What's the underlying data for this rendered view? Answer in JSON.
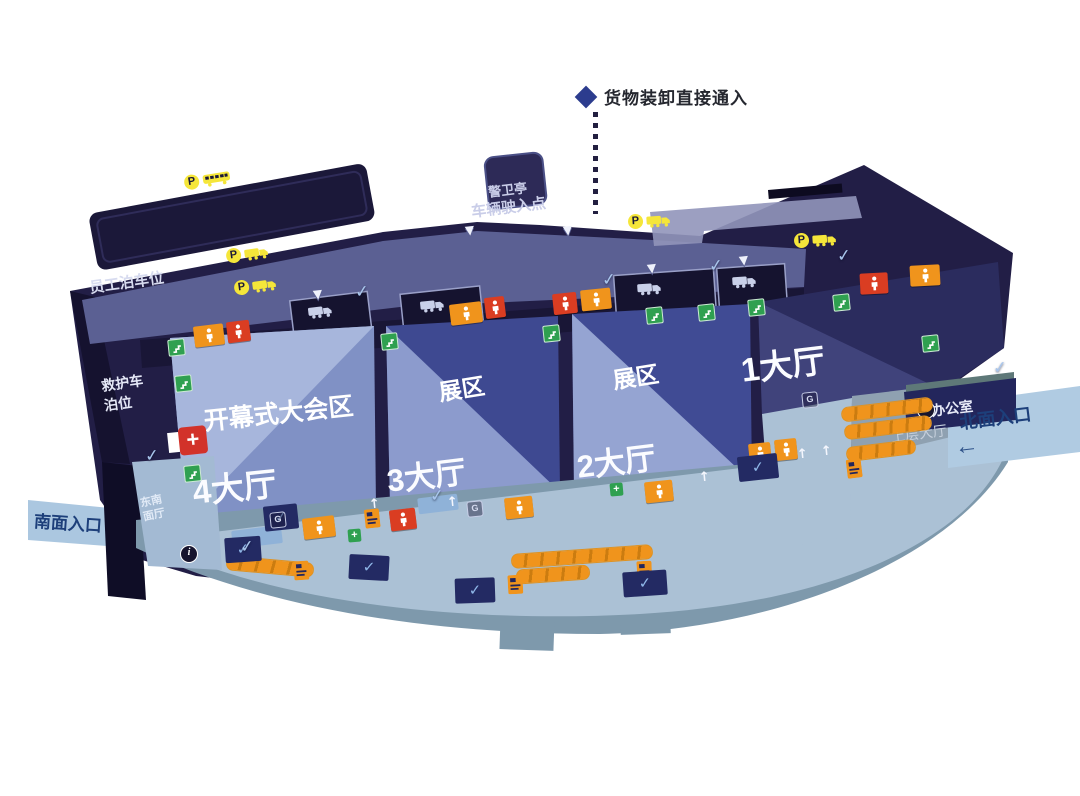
{
  "legend": {
    "label": "货物装卸直接通入"
  },
  "top_area": {
    "guard_booth": "警卫亭",
    "vehicle_entry_point": "车辆驶入点"
  },
  "west_area": {
    "staff_parking": "员工泊车位",
    "ambulance_parking_line1": "救护车",
    "ambulance_parking_line2": "泊位",
    "southeast_hall_line1": "东南",
    "southeast_hall_line2": "面厅"
  },
  "halls": {
    "hall1": {
      "name": "1大厅"
    },
    "hall2": {
      "name": "2大厅",
      "zone": "展区"
    },
    "hall3": {
      "name": "3大厅",
      "zone": "展区"
    },
    "hall4": {
      "name": "4大厅",
      "zone": "开幕式大会区"
    }
  },
  "east_area": {
    "office": "办公室",
    "upper_hall": "上层大厅",
    "north_entrance": "北面入口"
  },
  "south_area": {
    "south_entrance": "南面入口"
  },
  "icons": {
    "diamond": {
      "name": "legend-diamond-icon"
    },
    "parking": {
      "name": "parking-icon",
      "glyph": "P"
    },
    "bus": {
      "name": "bus-icon"
    },
    "truck": {
      "name": "truck-icon"
    },
    "dock_truck": {
      "name": "loading-dock-truck-icon"
    },
    "toilet": {
      "name": "toilet-icon"
    },
    "exit": {
      "name": "exit-stairs-icon"
    },
    "first_aid": {
      "name": "first-aid-icon",
      "glyph": "+"
    },
    "info": {
      "name": "info-icon",
      "glyph": "i"
    },
    "escalator": {
      "name": "escalator-icon"
    },
    "ticket": {
      "name": "ticket-machine-icon"
    },
    "check": {
      "name": "entrance-check-icon",
      "glyph": "✓"
    },
    "down": {
      "name": "down-arrow-icon",
      "glyph": "▼"
    },
    "up": {
      "name": "up-arrow-icon",
      "glyph": "↑"
    },
    "left_arrow": {
      "name": "left-arrow-icon",
      "glyph": "←"
    },
    "facility": {
      "name": "facility-icon",
      "glyph": "G"
    }
  },
  "colors": {
    "building": "#221e46",
    "road_band": "#5b6093",
    "hall_light": "#a7b6dc",
    "hall_mid": "#8091c5",
    "hall_dark": "#3e4991",
    "hall1_dark": "#2b2c5e",
    "plaza": "#abc1d5",
    "plaza_edge": "#7e99ac",
    "banner": "#abc7e0",
    "orange": "#f0941c",
    "red": "#da3d22",
    "yellow": "#f5e63a",
    "green": "#2fa050",
    "navy_badge": "#232a63",
    "entrance_text": "#1d3f7a"
  }
}
